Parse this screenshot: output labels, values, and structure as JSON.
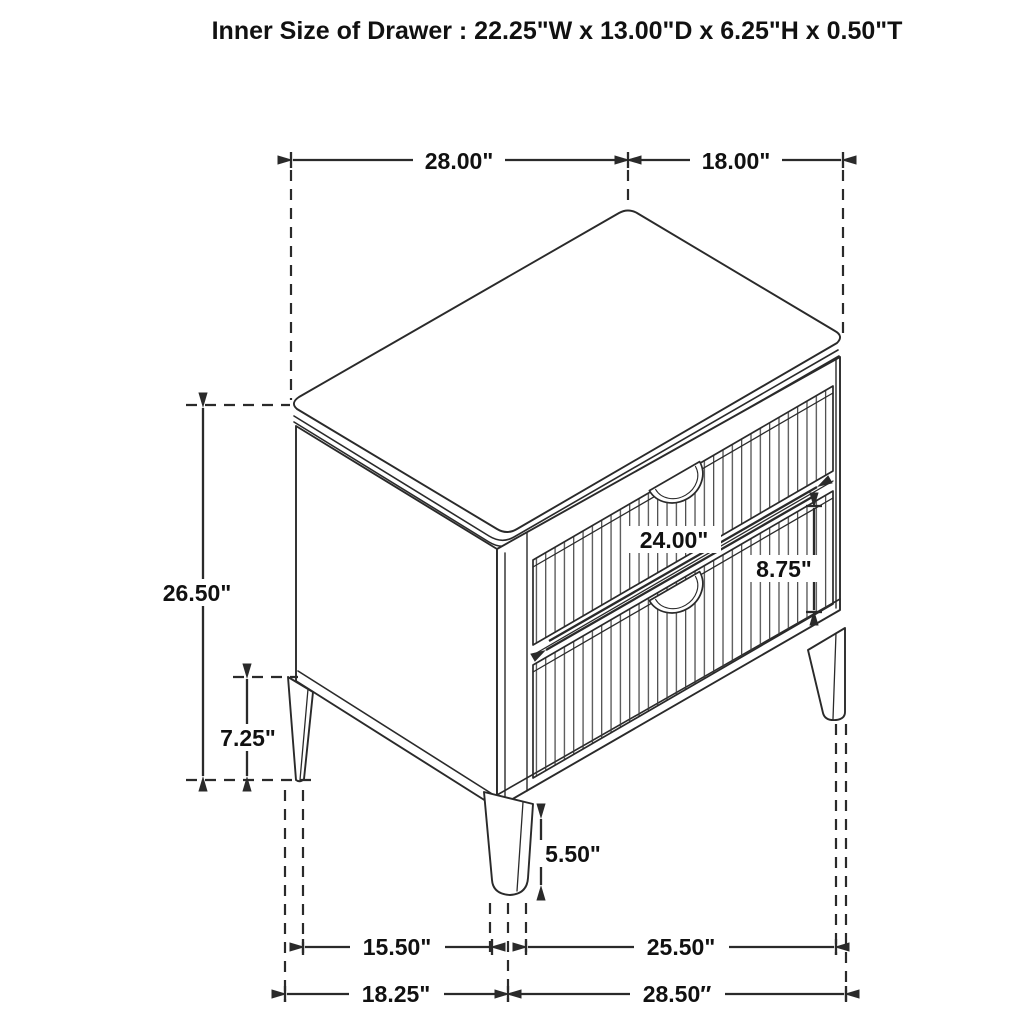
{
  "title": "Inner Size of Drawer : 22.25\"W x 13.00\"D x 6.25\"H x 0.50\"T",
  "dims": {
    "top_width": "28.00\"",
    "top_depth": "18.00\"",
    "overall_height": "26.50\"",
    "base_height": "7.25\"",
    "drawer_width": "24.00\"",
    "drawer_front_height": "8.75\"",
    "leg_height": "5.50\"",
    "leg_span_side": "15.50\"",
    "leg_span_front": "25.50\"",
    "base_depth": "18.25\"",
    "base_width": "28.50″"
  },
  "colors": {
    "line": "#2a2a2a",
    "text": "#111111",
    "background": "#ffffff"
  }
}
